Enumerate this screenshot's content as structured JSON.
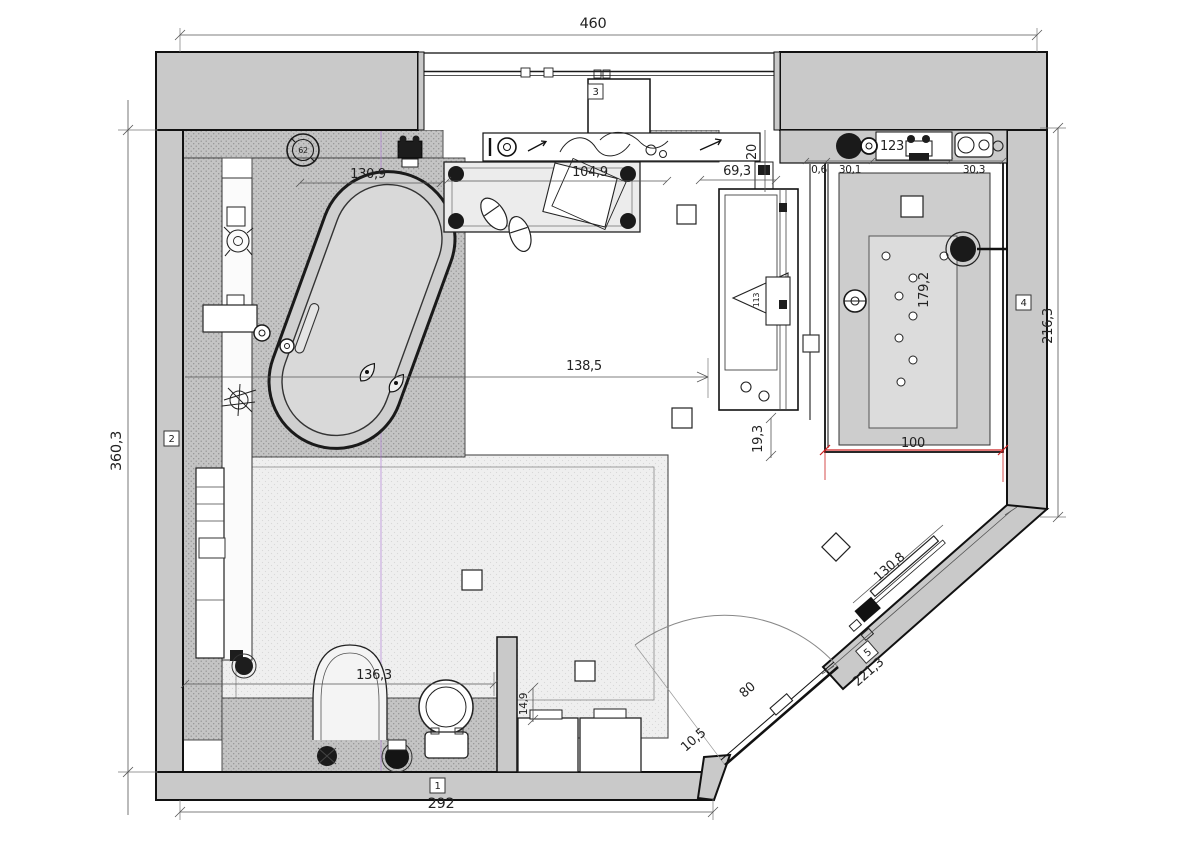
{
  "dims": {
    "top_width": "460",
    "left_height": "360,3",
    "bottom_width": "292",
    "right_height": "216,3",
    "platform_width": "130,9",
    "bench_width": "104,9",
    "recess_width": "69,3",
    "door_clearance": "20",
    "glass_thickness": "0,6",
    "panel_width": "30,1",
    "shower_top_width": "123",
    "corner_width": "30,3",
    "shower_length": "179,2",
    "floor_span": "138,5",
    "edge_gap": "19,3",
    "shower_width": "100",
    "rug_width": "136,3",
    "stool_depth": "14,9",
    "door_swing": "80",
    "hinge_offset": "10,5",
    "radiator_length": "130,8",
    "diagonal_wall_length": "221,3",
    "heater_width": "113"
  },
  "markers": {
    "wall_1": "1",
    "wall_2": "2",
    "wall_3": "3",
    "wall_4": "4",
    "wall_5": "5"
  },
  "symbols": {
    "dial_reading": "62"
  },
  "colors": {
    "wall_fill": "#c9c9c9",
    "line": "#1a1a1a",
    "dim_line": "#3d3d3d",
    "accent_red": "#cc2020",
    "shower_floor": "#cdcdcd",
    "rug_fill": "#efefef",
    "hatch_fill": "#c4c4c4",
    "centerline_violet": "#b07fd6"
  }
}
